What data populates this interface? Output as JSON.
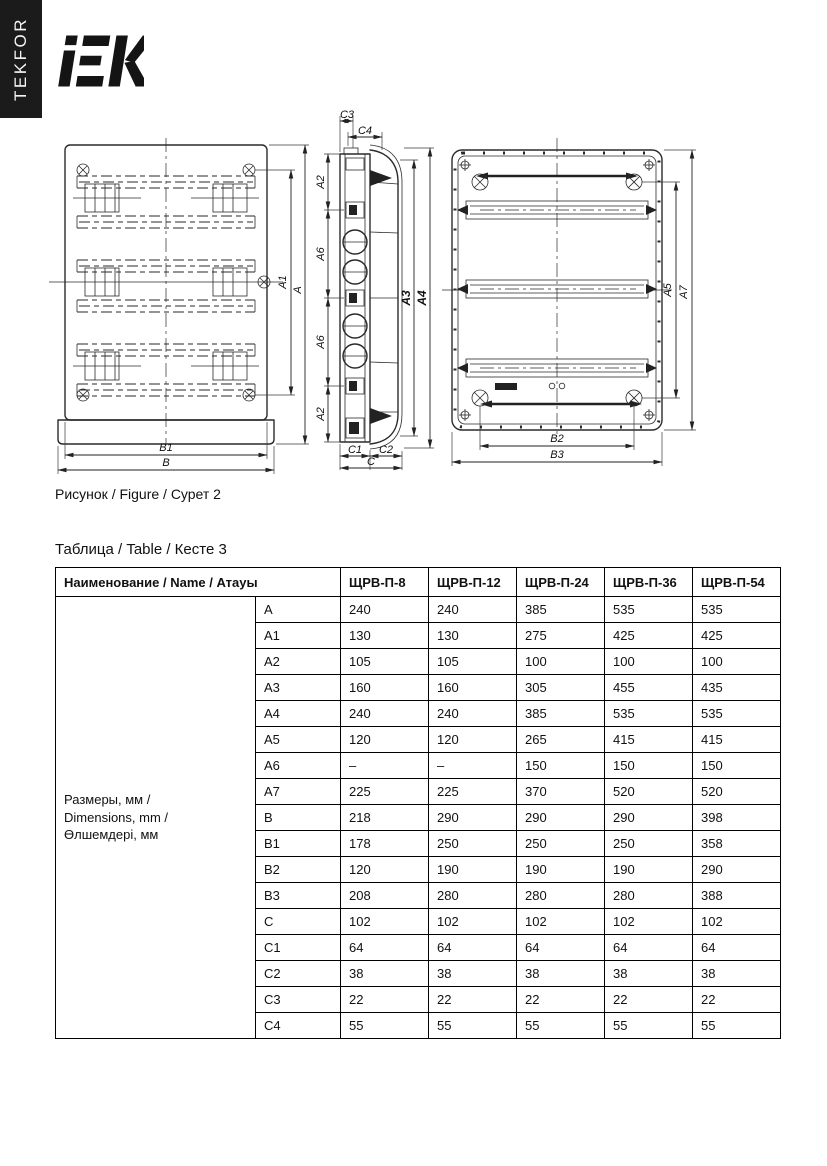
{
  "brand": {
    "tekfor": "TEKFOR",
    "logo_text": "IEK",
    "bar_color": "#1b1b1b"
  },
  "figure": {
    "caption": "Рисунок / Figure / Сурет 2",
    "front": {
      "a1": "A1",
      "a": "A",
      "b1": "B1",
      "b": "B"
    },
    "side": {
      "c3": "C3",
      "c4": "C4",
      "a2_top": "A2",
      "a6_upper": "A6",
      "a6_lower": "A6",
      "a2_bottom": "A2",
      "a3": "A3",
      "a4": "A4",
      "c1": "C1",
      "c2": "C2",
      "c": "C"
    },
    "rear": {
      "a5": "A5",
      "a7": "A7",
      "b2": "B2",
      "b3": "B3"
    }
  },
  "table": {
    "title": "Таблица / Table / Кесте 3",
    "header": {
      "name_col": "Наименование / Name / Атауы",
      "models": [
        "ЩРВ-П-8",
        "ЩРВ-П-12",
        "ЩРВ-П-24",
        "ЩРВ-П-36",
        "ЩРВ-П-54"
      ]
    },
    "group_label": "Размеры, мм /\nDimensions, mm /\nӨлшемдері, мм",
    "rows": [
      {
        "param": "A",
        "values": [
          "240",
          "240",
          "385",
          "535",
          "535"
        ]
      },
      {
        "param": "A1",
        "values": [
          "130",
          "130",
          "275",
          "425",
          "425"
        ]
      },
      {
        "param": "A2",
        "values": [
          "105",
          "105",
          "100",
          "100",
          "100"
        ]
      },
      {
        "param": "A3",
        "values": [
          "160",
          "160",
          "305",
          "455",
          "435"
        ]
      },
      {
        "param": "A4",
        "values": [
          "240",
          "240",
          "385",
          "535",
          "535"
        ]
      },
      {
        "param": "A5",
        "values": [
          "120",
          "120",
          "265",
          "415",
          "415"
        ]
      },
      {
        "param": "A6",
        "values": [
          "–",
          "–",
          "150",
          "150",
          "150"
        ]
      },
      {
        "param": "A7",
        "values": [
          "225",
          "225",
          "370",
          "520",
          "520"
        ]
      },
      {
        "param": "B",
        "values": [
          "218",
          "290",
          "290",
          "290",
          "398"
        ]
      },
      {
        "param": "B1",
        "values": [
          "178",
          "250",
          "250",
          "250",
          "358"
        ]
      },
      {
        "param": "B2",
        "values": [
          "120",
          "190",
          "190",
          "190",
          "290"
        ]
      },
      {
        "param": "B3",
        "values": [
          "208",
          "280",
          "280",
          "280",
          "388"
        ]
      },
      {
        "param": "C",
        "values": [
          "102",
          "102",
          "102",
          "102",
          "102"
        ]
      },
      {
        "param": "C1",
        "values": [
          "64",
          "64",
          "64",
          "64",
          "64"
        ]
      },
      {
        "param": "C2",
        "values": [
          "38",
          "38",
          "38",
          "38",
          "38"
        ]
      },
      {
        "param": "C3",
        "values": [
          "22",
          "22",
          "22",
          "22",
          "22"
        ]
      },
      {
        "param": "C4",
        "values": [
          "55",
          "55",
          "55",
          "55",
          "55"
        ]
      }
    ]
  }
}
